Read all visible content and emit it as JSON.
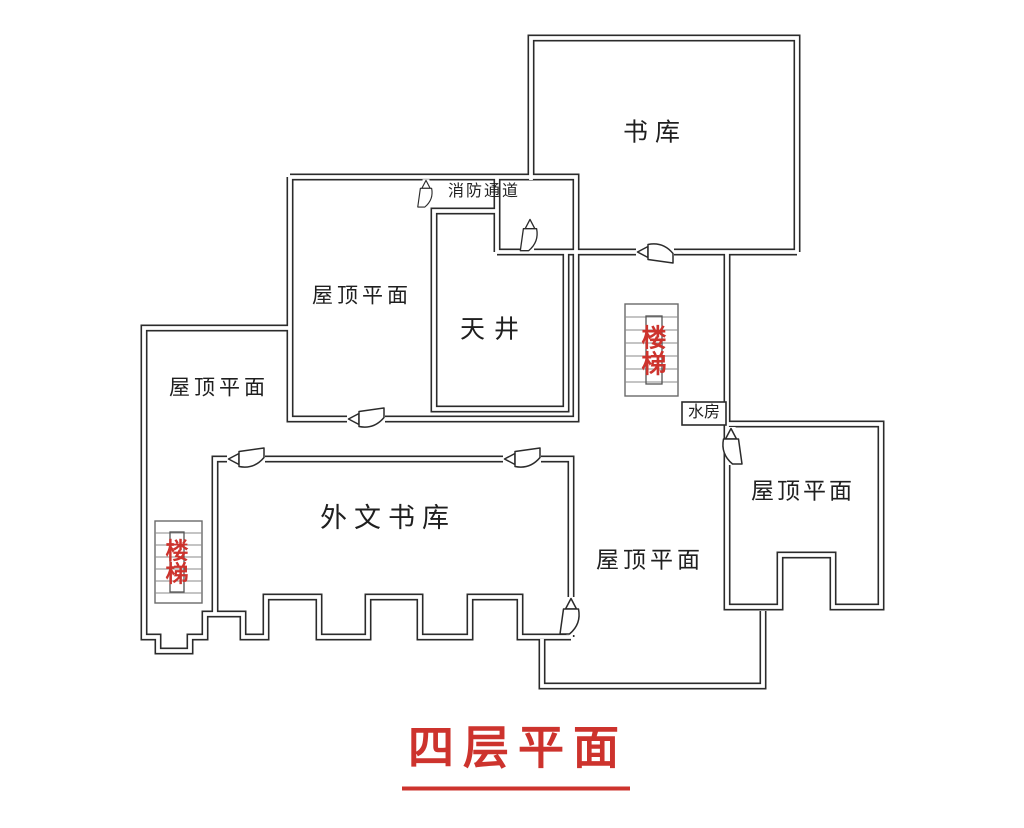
{
  "plan": {
    "title": "四层平面",
    "labels": {
      "book_storage": "书库",
      "fire_escape_passage": "消防通道",
      "roof_plane_mid": "屋顶平面",
      "light_well": "天井",
      "roof_plane_left": "屋顶平面",
      "foreign_language_book_storage": "外文书库",
      "roof_plane_open": "屋顶平面",
      "roof_plane_right": "屋顶平面",
      "water_room": "水房",
      "stairs_left": "楼梯",
      "stairs_right": "楼梯"
    },
    "icons": {
      "door": "door-swing-icon",
      "stairs": "stairs-icon"
    },
    "colors": {
      "wall": "#2b2b2b",
      "label_text": "#1f1f1f",
      "accent_red": "#cd332d",
      "stair_step_gray": "#8a8a8a"
    }
  }
}
